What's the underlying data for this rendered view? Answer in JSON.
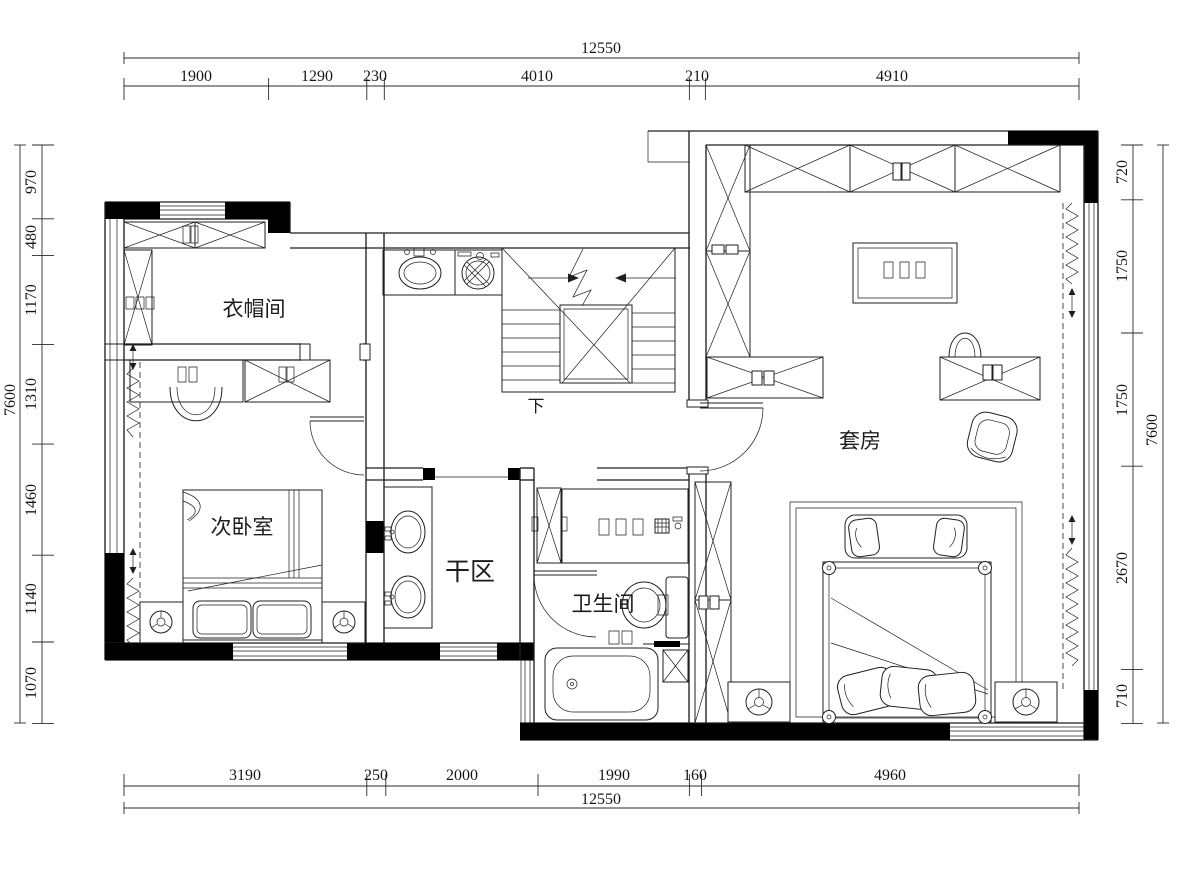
{
  "title": "二层平面布置图",
  "colors": {
    "background": "#ffffff",
    "line": "#1f1f1f",
    "dimension": "#2b2b2b",
    "column_fill": "#000000"
  },
  "rooms": {
    "cloakroom": "衣帽间",
    "secondary_bedroom": "次卧室",
    "dry_area": "干区",
    "bathroom": "卫生间",
    "suite": "套房",
    "stairs_down": "下"
  },
  "dimensions": {
    "top": {
      "total": "12550",
      "segments": [
        "1900",
        "1290",
        "230",
        "4010",
        "210",
        "4910"
      ]
    },
    "bottom": {
      "total": "12550",
      "segments": [
        "3190",
        "250",
        "2000",
        "1990",
        "160",
        "4960"
      ]
    },
    "left": {
      "total": "7600",
      "segments": [
        "970",
        "480",
        "1170",
        "1310",
        "1460",
        "1140",
        "1070"
      ]
    },
    "right": {
      "total": "7600",
      "segments": [
        "720",
        "1750",
        "1750",
        "2670",
        "710"
      ]
    }
  }
}
